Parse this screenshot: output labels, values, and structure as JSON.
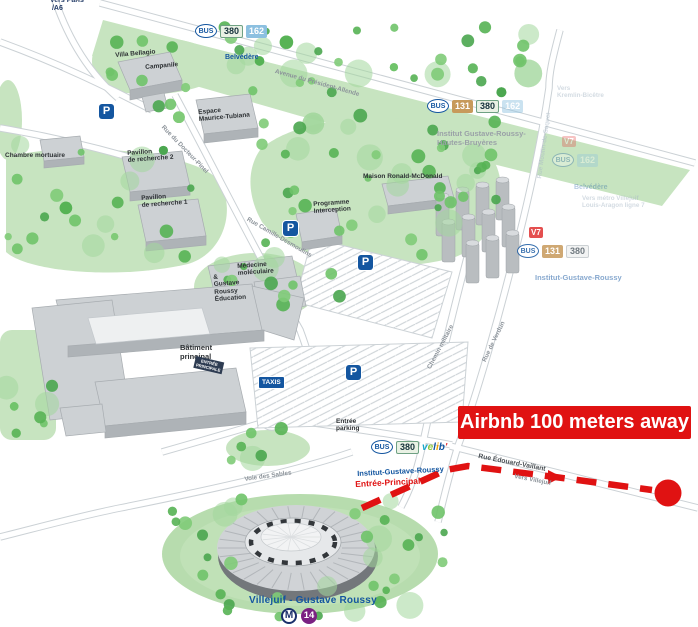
{
  "annotation": {
    "airbnb": "Airbnb 100 meters away"
  },
  "labels": [
    {
      "id": "vers-paris",
      "text": "Vers Paris\n /A6",
      "x": 50,
      "y": -3,
      "rot": 0,
      "cls": "s-dark"
    },
    {
      "id": "vers-paris-arrow",
      "text": "➤",
      "x": 78,
      "y": 3,
      "rot": 200,
      "cls": "s-arrow"
    },
    {
      "id": "villa-bellagio",
      "text": "Villa Bellagio",
      "x": 115,
      "y": 52,
      "rot": -5,
      "cls": "s-building"
    },
    {
      "id": "campanile",
      "text": "Campanile",
      "x": 145,
      "y": 64,
      "rot": -5,
      "cls": "s-building"
    },
    {
      "id": "espace-maurice-tubiana",
      "text": "Espace\nMaurice-Tubiana",
      "x": 198,
      "y": 109,
      "rot": -5,
      "cls": "s-building"
    },
    {
      "id": "chambre-mortuaire",
      "text": "Chambre mortuaire",
      "x": 5,
      "y": 152,
      "rot": 0,
      "cls": "s-building"
    },
    {
      "id": "pavillon-recherche-2",
      "text": "Pavillon\nde recherche 2",
      "x": 127,
      "y": 150,
      "rot": -4,
      "cls": "s-building"
    },
    {
      "id": "pavillon-recherche-1",
      "text": "Pavillon\nde recherche 1",
      "x": 141,
      "y": 195,
      "rot": -4,
      "cls": "s-building"
    },
    {
      "id": "maison-ronald-mcdonald",
      "text": "Maison Ronald-McDonald",
      "x": 363,
      "y": 173,
      "rot": 0,
      "cls": "s-building"
    },
    {
      "id": "programme-interception",
      "text": "Programme\nInterception",
      "x": 313,
      "y": 201,
      "rot": -4,
      "cls": "s-building"
    },
    {
      "id": "medecine-moleculaire",
      "text": "Médecine\nmoléculaire",
      "x": 237,
      "y": 263,
      "rot": -4,
      "cls": "s-building"
    },
    {
      "id": "gustave-roussy-education",
      "text": "&\nGustave\nRoussy\nÉducation",
      "x": 213,
      "y": 274,
      "rot": -4,
      "cls": "s-building"
    },
    {
      "id": "batiment-principal",
      "text": "Bâtiment\nprincipal",
      "x": 180,
      "y": 344,
      "rot": 0,
      "cls": "s-building-lg"
    },
    {
      "id": "entree-principale-sign",
      "text": "ENTRÉE\nPRINCIPALE",
      "x": 196,
      "y": 356,
      "rot": 13,
      "cls": "s-sign"
    },
    {
      "id": "entree-parking",
      "text": "Entrée\nparking",
      "x": 336,
      "y": 418,
      "rot": 0,
      "cls": "s-building"
    },
    {
      "id": "avenue-president-allende",
      "text": "Avenue du Président-Allende",
      "x": 276,
      "y": 68,
      "rot": 15.5,
      "cls": "s-road"
    },
    {
      "id": "rue-docteur-pinel",
      "text": "Rue du Docteur-Pinel",
      "x": 165,
      "y": 124,
      "rot": 46,
      "cls": "s-road"
    },
    {
      "id": "rue-camille-desmoulins",
      "text": "Rue Camille-Desmoulins",
      "x": 249,
      "y": 216,
      "rot": 30,
      "cls": "s-road"
    },
    {
      "id": "chemin-militaire",
      "text": "Chemin militaire",
      "x": 426,
      "y": 367,
      "rot": -62,
      "cls": "s-road"
    },
    {
      "id": "rue-de-verdun",
      "text": "Rue de Verdun",
      "x": 481,
      "y": 360,
      "rot": -64,
      "cls": "s-road"
    },
    {
      "id": "rue-moulin-de-saquet",
      "text": "Rue Moulin-de-Saquet",
      "x": 536,
      "y": 178,
      "rot": -82,
      "cls": "s-faded",
      "op": 0.5
    },
    {
      "id": "voie-des-sables",
      "text": "Voie des Sables",
      "x": 244,
      "y": 476,
      "rot": -8,
      "cls": "s-road"
    },
    {
      "id": "rue-edouard-vaillant",
      "text": "Rue Édouard-Vaillant",
      "x": 479,
      "y": 453,
      "rot": 11,
      "cls": "s-road-dark"
    },
    {
      "id": "vers-villejuif",
      "text": "Vers Villejuif",
      "x": 515,
      "y": 473,
      "rot": 11,
      "cls": "s-road"
    },
    {
      "id": "vers-kremlin-bicetre",
      "text": "Vers\nKremlin-Bicêtre",
      "x": 557,
      "y": 85,
      "rot": 0,
      "cls": "s-faded",
      "op": 0.5
    },
    {
      "id": "vers-metro-louis-aragon",
      "text": "Vers métro Villejuif\nLouis-Aragon ligne 7",
      "x": 582,
      "y": 195,
      "rot": 0,
      "cls": "s-faded",
      "op": 0.5
    },
    {
      "id": "villejuif-gustave-roussy",
      "text": "Villejuif - Gustave Roussy",
      "x": 249,
      "y": 595,
      "rot": 0,
      "cls": "s-blue-lg"
    }
  ],
  "bus_stops": [
    {
      "id": "stop-belvedere",
      "x": 195,
      "y": 24,
      "op": 1,
      "badges": [
        {
          "t": "BUS",
          "cls": "b-bus"
        },
        {
          "t": "380",
          "cls": "b-380"
        },
        {
          "t": "162",
          "cls": "b-162"
        }
      ],
      "labels": [
        {
          "t": "Belvédère",
          "cls": "s-blue",
          "dx": 30,
          "dy": 16
        }
      ]
    },
    {
      "id": "stop-hautes-bruyeres",
      "x": 427,
      "y": 99,
      "op": 1,
      "badges": [
        {
          "t": "BUS",
          "cls": "b-bus"
        },
        {
          "t": "131",
          "cls": "b-131"
        },
        {
          "t": "380",
          "cls": "b-380"
        },
        {
          "t": "162",
          "cls": "b-162f"
        }
      ],
      "labels": [
        {
          "t": "Institut Gustave-Roussy-\nHautes-Bruyères",
          "cls": "s-gray",
          "dx": 10,
          "dy": 17
        }
      ]
    },
    {
      "id": "stop-faded-162",
      "x": 552,
      "y": 153,
      "op": 0.32,
      "badges": [
        {
          "t": "BUS",
          "cls": "b-bus"
        },
        {
          "t": "162",
          "cls": "b-162"
        }
      ],
      "labels": [
        {
          "t": "Belvédère",
          "cls": "s-blue",
          "dx": 22,
          "dy": 17
        }
      ]
    },
    {
      "id": "stop-institut-gustave-roussy",
      "x": 517,
      "y": 244,
      "op": 0.85,
      "badges": [
        {
          "t": "BUS",
          "cls": "b-bus"
        },
        {
          "t": "131",
          "cls": "b-131"
        },
        {
          "t": "380",
          "cls": "b-380f"
        }
      ],
      "labels": [
        {
          "t": "Institut-Gustave-Roussy",
          "cls": "s-blue-md",
          "dx": 18,
          "dy": 16,
          "op": 0.6
        }
      ]
    },
    {
      "id": "stop-entree-principal",
      "x": 371,
      "y": 440,
      "op": 1,
      "badges": [
        {
          "t": "BUS",
          "cls": "b-bus"
        },
        {
          "t": "380",
          "cls": "b-380"
        },
        {
          "t": "velib'",
          "cls": "b-velib"
        }
      ],
      "labels": [
        {
          "t": "Institut-Gustave-Roussy",
          "cls": "s-blue-md",
          "dx": -14,
          "dy": 16,
          "rot": -3
        },
        {
          "t": "Entrée-Principal",
          "cls": "s-red",
          "dx": -16,
          "dy": 26,
          "rot": -3
        }
      ]
    }
  ],
  "standalone_badges": [
    {
      "id": "v7-badge",
      "t": "V7",
      "x": 529,
      "y": 227,
      "op": 0.9
    },
    {
      "id": "v7-badge-faded",
      "t": "V7",
      "x": 562,
      "y": 136,
      "op": 0.3
    }
  ],
  "parking": {
    "letter": "P",
    "positions": [
      [
        99,
        104
      ],
      [
        283,
        221
      ],
      [
        358,
        255
      ],
      [
        346,
        365
      ]
    ]
  },
  "taxis": {
    "label": "TAXIS",
    "x": 259,
    "y": 377
  },
  "metro": {
    "m": "M",
    "line": "14"
  },
  "colors": {
    "route_red": "#e01212",
    "map_blue": "#1456a0",
    "green": "#c7e4c0"
  }
}
